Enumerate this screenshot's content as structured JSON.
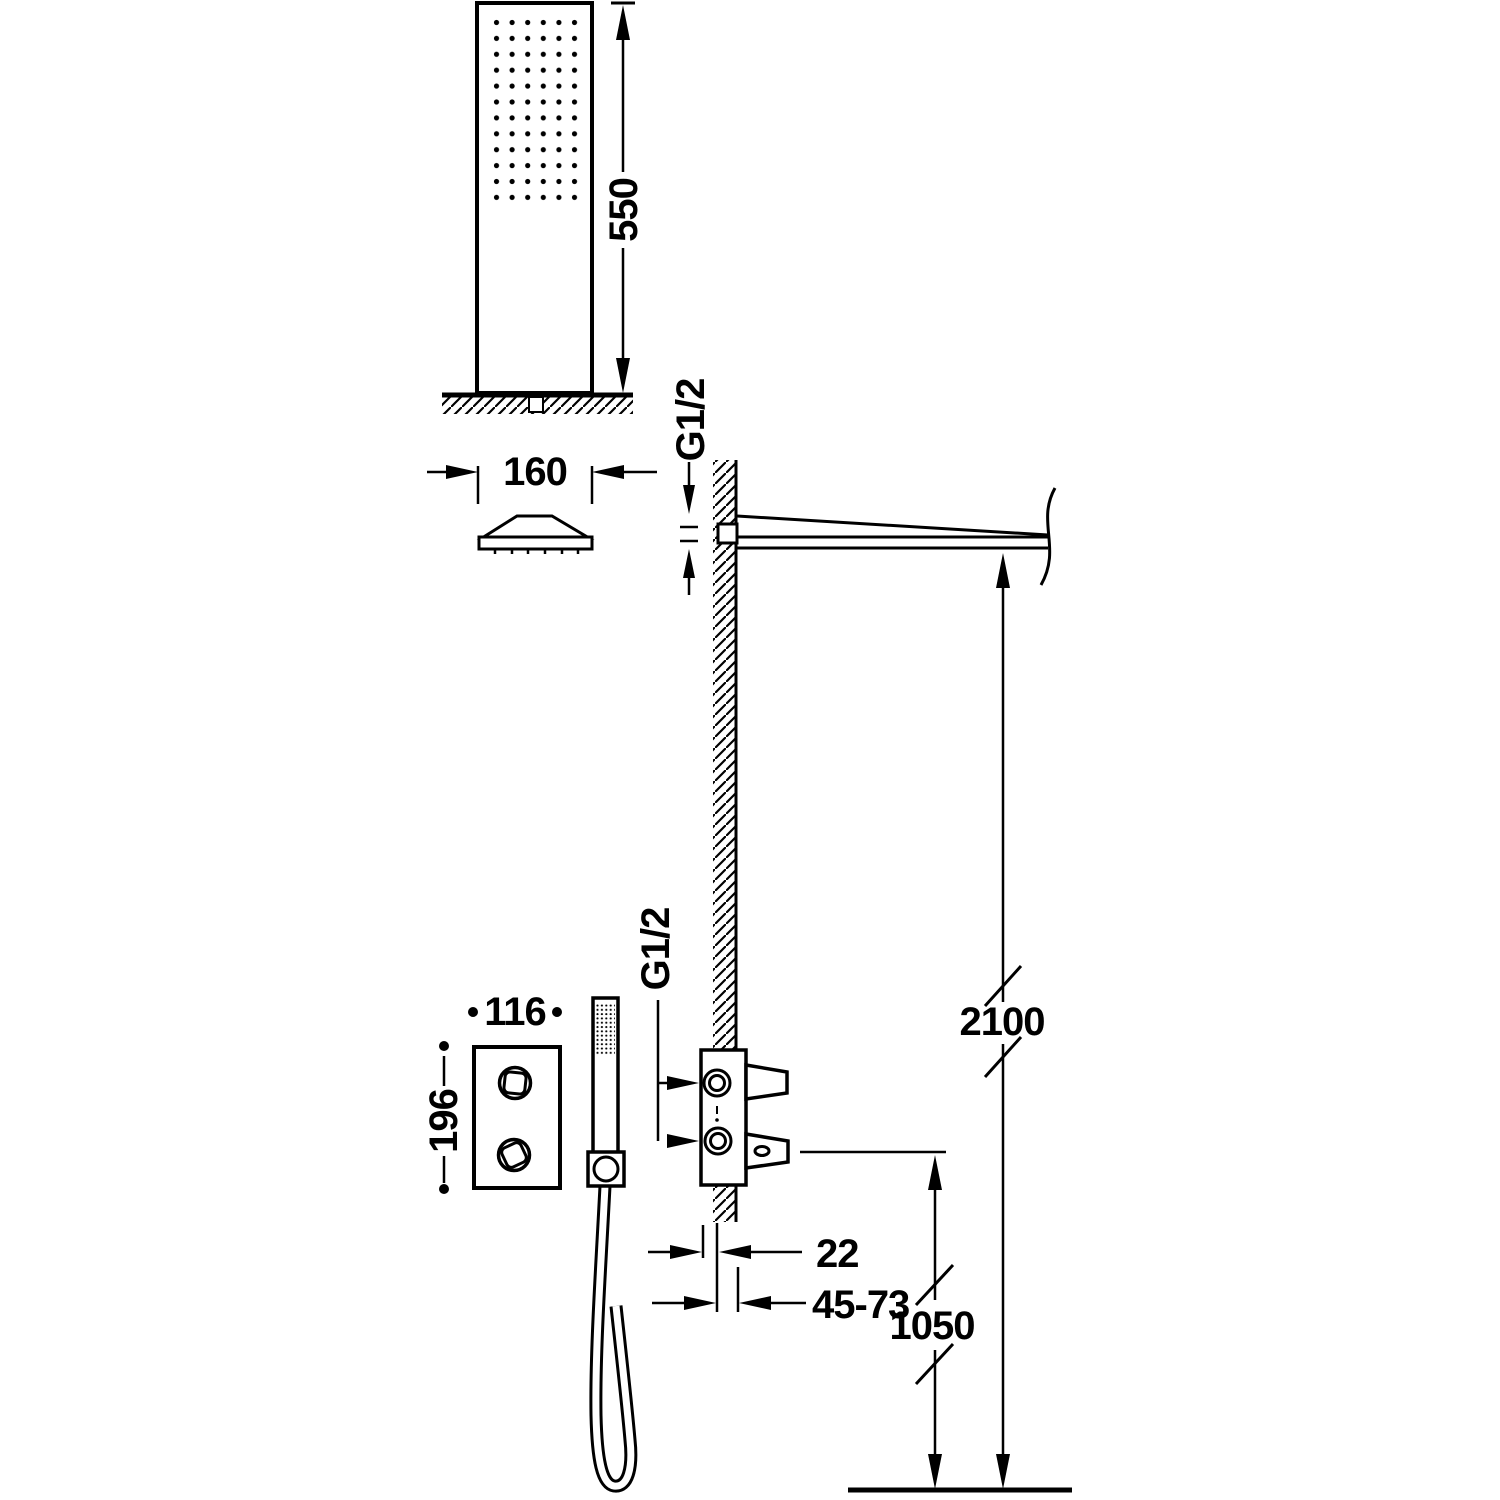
{
  "dims": {
    "column_height": "550",
    "head_width": "160",
    "arm_thread": "G1/2",
    "outlet_thread": "G1/2",
    "panel_width": "116",
    "panel_height": "196",
    "arm_install_height": "2100",
    "valve_install_height": "1050",
    "valve_wall_offset": "22",
    "valve_depth_range": "45-73"
  }
}
